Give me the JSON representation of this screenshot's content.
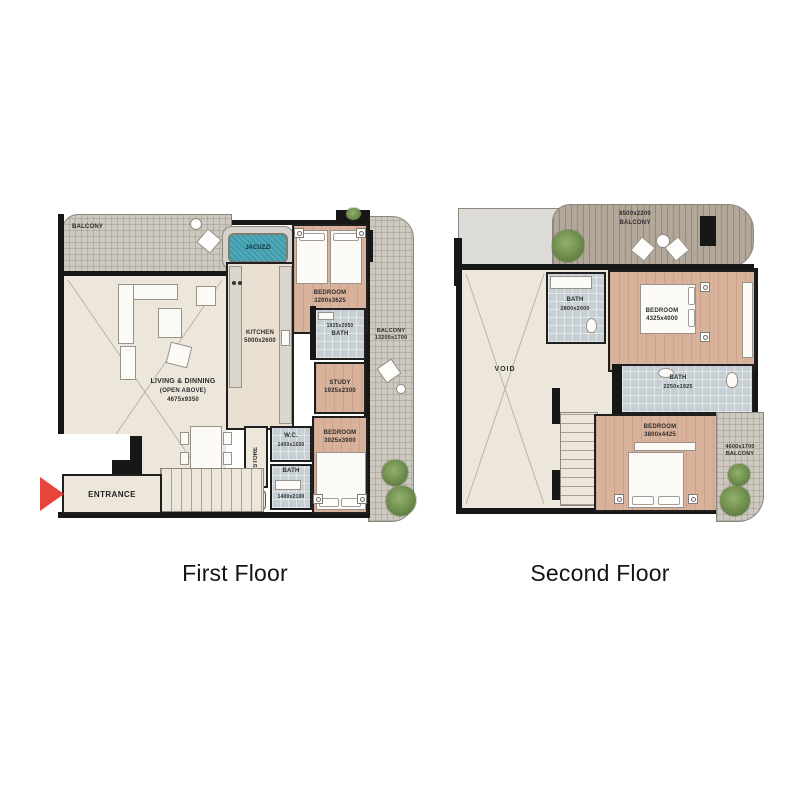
{
  "captions": {
    "first_floor": "First Floor",
    "second_floor": "Second Floor"
  },
  "colors": {
    "wall": "#171717",
    "wood_floor": "#d8b29b",
    "cream_floor": "#ece7da",
    "tile_floor": "#c6cfd3",
    "balcony_hatch": "#cdc9c0",
    "balcony_slats": "#b3a79a",
    "jacuzzi_teal": "#3c9cad",
    "entrance_arrow_red": "#e8443e"
  },
  "first_floor": {
    "balcony_top": {
      "name": "BALCONY"
    },
    "jacuzzi": {
      "name": "JACUZZI"
    },
    "bedroom_top": {
      "name": "BEDROOM",
      "dims": "3200x3625"
    },
    "kitchen": {
      "name": "KITCHEN",
      "dims": "5000x2600"
    },
    "bath_top": {
      "dims": "1925x2050",
      "name": "BATH"
    },
    "balcony_right": {
      "name": "BALCONY",
      "dims": "13200x1700"
    },
    "study": {
      "name": "STUDY",
      "dims": "1925x2300"
    },
    "living": {
      "name": "LIVING & DINNING",
      "note": "(OPEN ABOVE)",
      "dims": "4675x9350"
    },
    "store": {
      "name": "STORE"
    },
    "wc": {
      "name": "W.C.",
      "dims": "1400x1550"
    },
    "bath_bottom": {
      "name": "BATH",
      "dims": "1400x2100"
    },
    "bedroom_bottom": {
      "name": "BEDROOM",
      "dims": "3025x3900"
    },
    "entrance": {
      "name": "ENTRANCE"
    },
    "shaft": {
      "name": "PLM"
    }
  },
  "second_floor": {
    "balcony_top": {
      "dims": "8500x2200",
      "name": "BALCONY"
    },
    "bath_top": {
      "name": "BATH",
      "dims": "2800x2000"
    },
    "bedroom_top": {
      "name": "BEDROOM",
      "dims": "4325x4000"
    },
    "void": {
      "name": "VOID"
    },
    "bath_mid": {
      "name": "BATH",
      "dims": "2250x1925"
    },
    "bedroom_bottom": {
      "name": "BEDROOM",
      "dims": "3800x4425"
    },
    "balcony_right": {
      "dims": "4600x1700",
      "name": "BALCONY"
    }
  }
}
